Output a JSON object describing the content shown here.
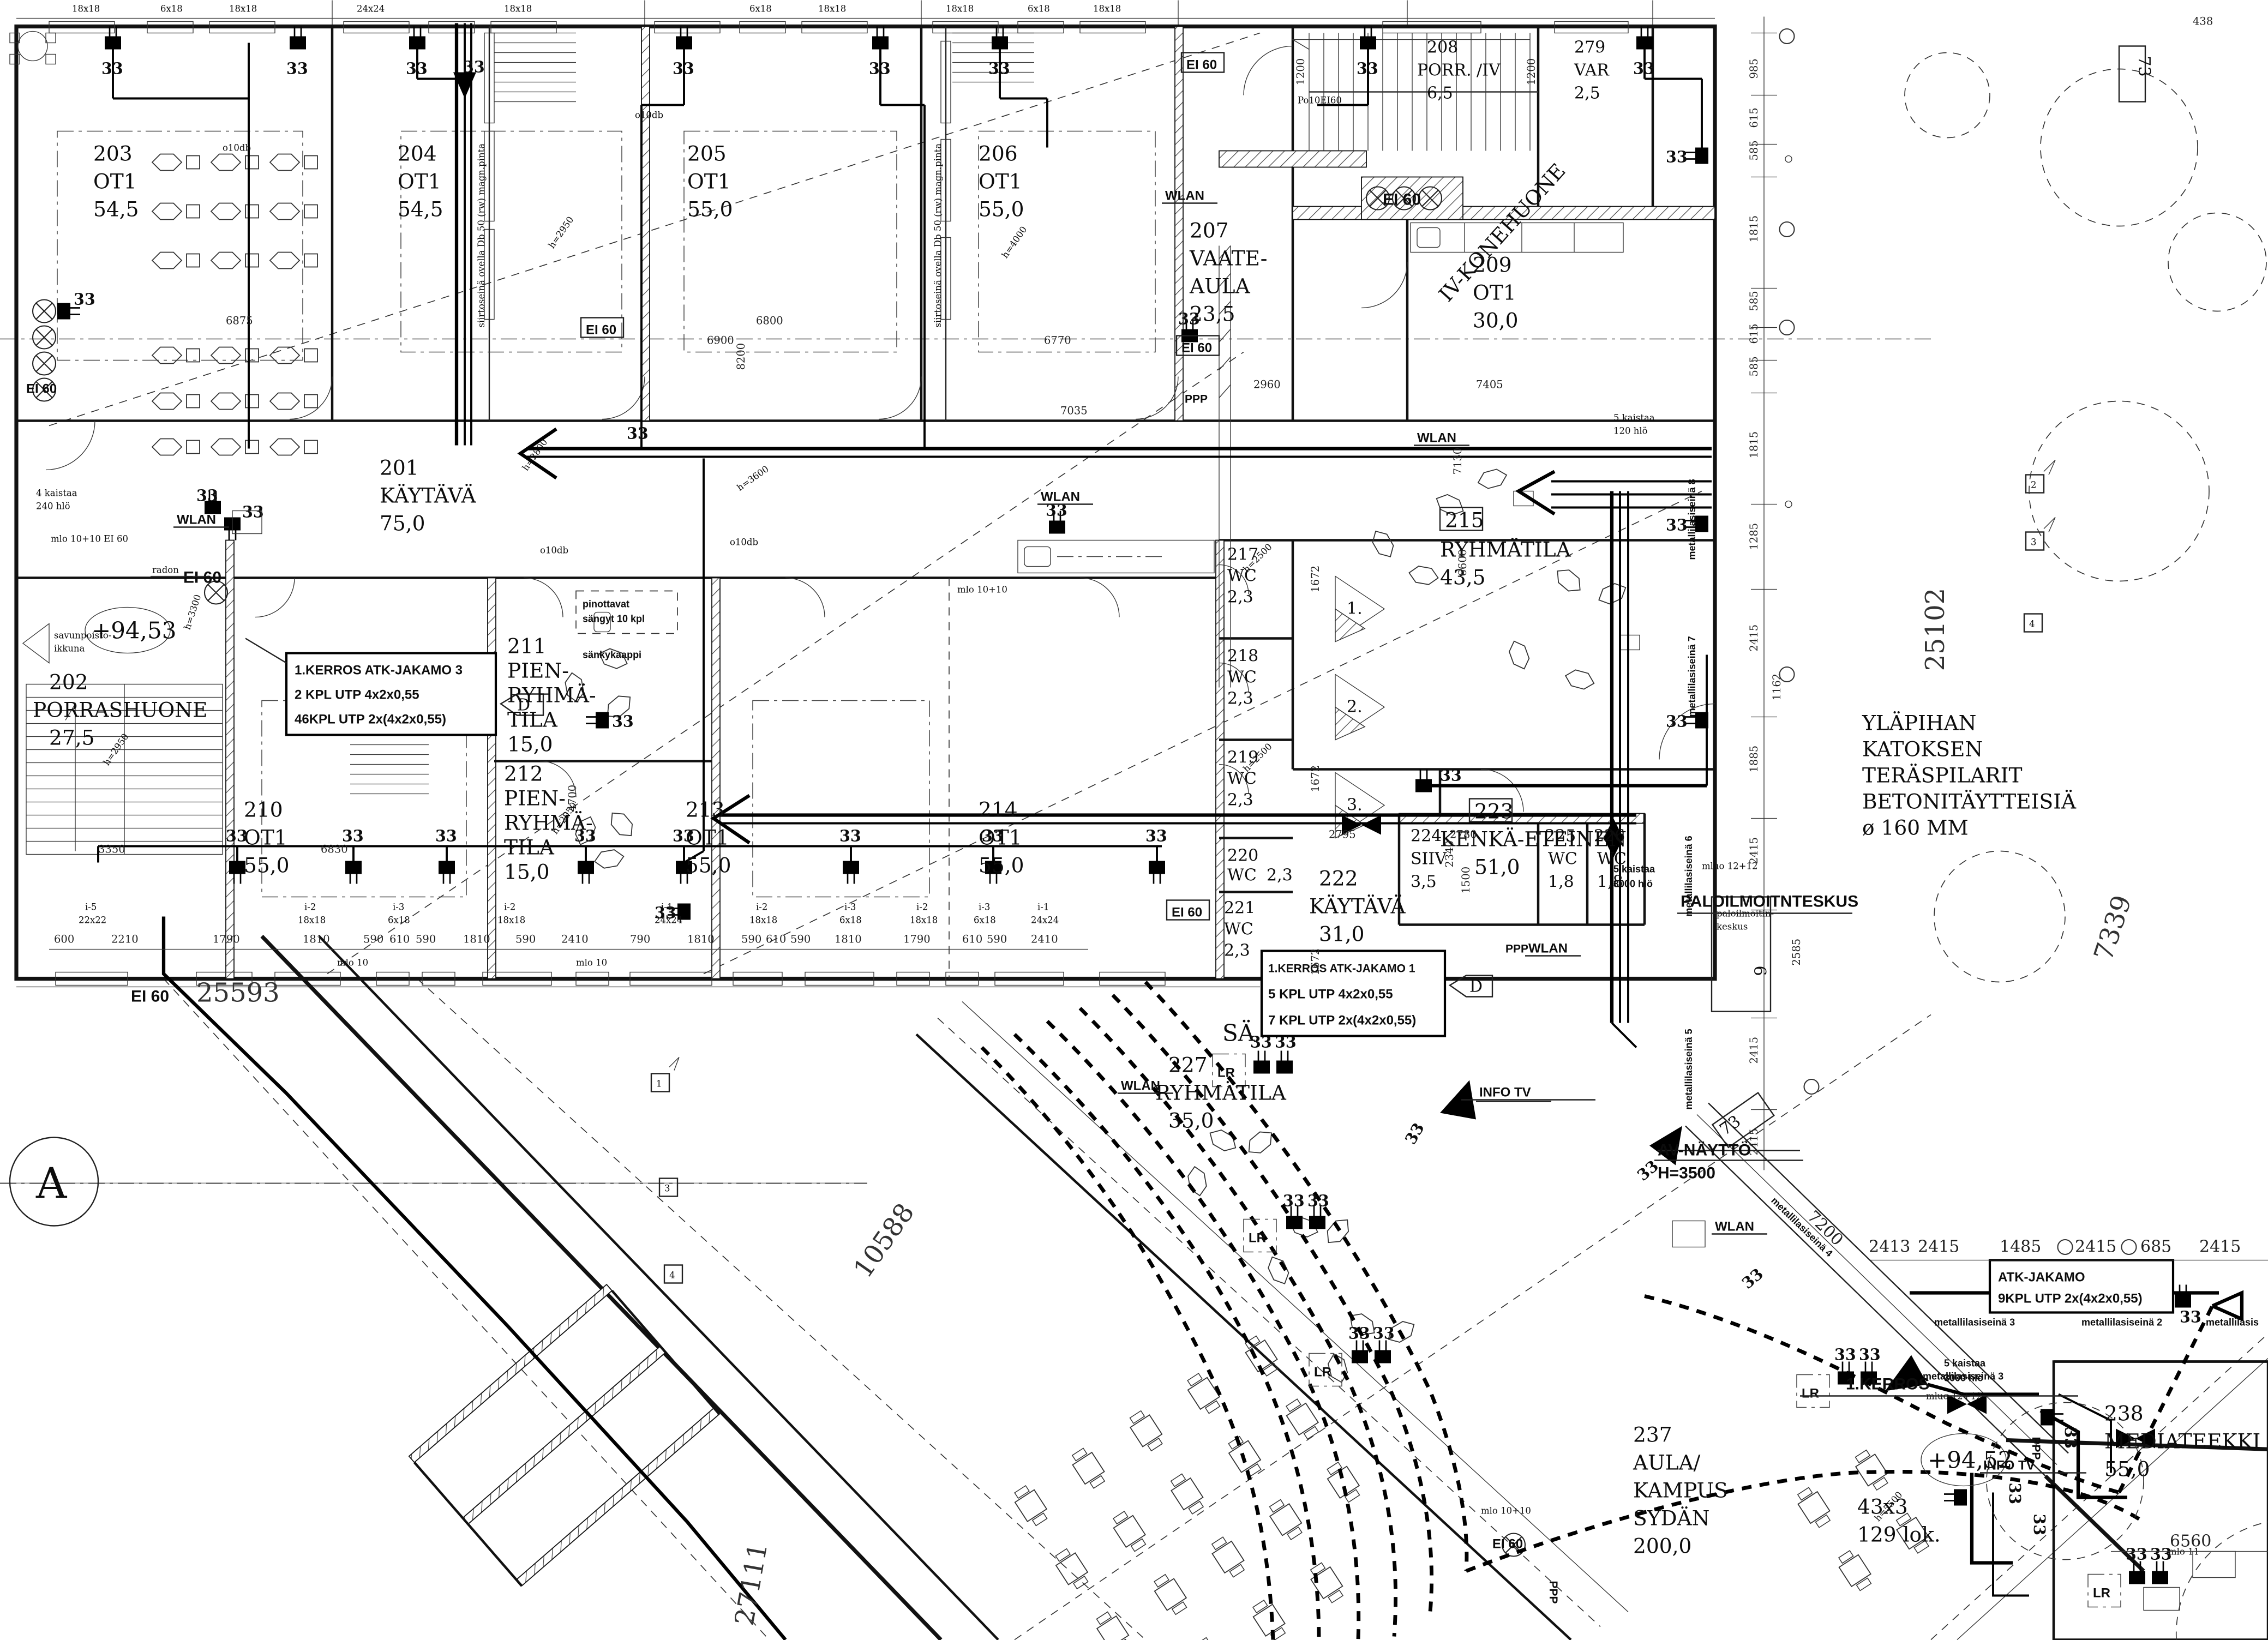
{
  "sheet": {
    "grid_letter": "A"
  },
  "labels": {
    "outlet": "33",
    "wlan": "WLAN",
    "ei60": "EI 60",
    "lr": "LR",
    "ppp": "PPP",
    "sa": "SÄ",
    "d_mark": "D",
    "info_tv": "INFO TV",
    "kerros": "1.KERROS",
    "radon": "radon",
    "o10db": "o10db",
    "mlo10": "mlo 10",
    "mlo1010": "mlo 10+10",
    "mlo1010ei60": "mlo 10+10 EI 60",
    "mlo11": "mlo 11",
    "mluo1212": "mluo 12+12",
    "po10ei60": "Po10EI60",
    "paloilmoitinkeskus": "PALOILMOITNTESKUS",
    "palok1": "paloilmoitin-",
    "palok2": "keskus",
    "palok_num": "6",
    "siirtoseina": "siirtoseinä ovella Db 50 (rw) magn.pinta",
    "pinottavat1": "pinottavat",
    "pinottavat2": "sängyt 10 kpl",
    "sankykaappi": "sänkykaappi",
    "savunpoisto1": "savunpoisto-",
    "savunpoisto2": "ikkuna",
    "kaistaa4": "4 kaistaa",
    "hlo240": "240 hlö",
    "kaistaa5": "5 kaistaa",
    "hlo120": "120 hlö",
    "hlo3000": "3000 hlö",
    "lok1": "43x3",
    "lok2": "129 lok.",
    "level_a": "+94,53",
    "level_b": "+94,52",
    "iv_konehuone": "IV-KONEHUONE",
    "num73": "73",
    "num1": "1",
    "num2": "2",
    "num3": "3",
    "num4": "4",
    "tri1": "1.",
    "tri2": "2.",
    "tri3": "3."
  },
  "annotations": {
    "atk3_l1": "1.KERROS ATK-JAKAMO 3",
    "atk3_l2": "2 KPL UTP 4x2x0,55",
    "atk3_l3": "46KPL UTP 2x(4x2x0,55)",
    "atk1_l1": "1.KERROS ATK-JAKAMO 1",
    "atk1_l2": "5 KPL UTP 4x2x0,55",
    "atk1_l3": "7 KPL UTP 2x(4x2x0,55)",
    "atk9_l1": "ATK-JAKAMO",
    "atk9_l2": "9KPL UTP 2x(4x2x0,55)",
    "av_l1": "AV-NÄYTTÖ",
    "av_l2": "H=3500",
    "ylapihan_l1": "YLÄPIHAN",
    "ylapihan_l2": "KATOKSEN",
    "ylapihan_l3": "TERÄSPILARIT",
    "ylapihan_l4": "BETONITÄYTTEISIÄ",
    "ylapihan_l5": "ø      160 MM",
    "metalli8": "metallilasiseinä 8",
    "metalli7": "metallilasiseinä 7",
    "metalli6": "metallilasiseinä 6",
    "metalli5": "metallilasiseinä 5",
    "metalli4": "metallilasiseinä 4",
    "metalli3": "metallilasiseinä 3",
    "metalli2": "metallilasiseinä 2",
    "metalli1": "metallilasis"
  },
  "rooms": {
    "r201": [
      "201",
      "KÄYTÄVÄ",
      "75,0"
    ],
    "r202": [
      "202",
      "PORRASHUONE",
      "27,5"
    ],
    "r203": [
      "203",
      "OT1",
      "54,5"
    ],
    "r204": [
      "204",
      "OT1",
      "54,5"
    ],
    "r205": [
      "205",
      "OT1",
      "55,0"
    ],
    "r206": [
      "206",
      "OT1",
      "55,0"
    ],
    "r207": [
      "207",
      "VAATE-",
      "AULA",
      "23,5"
    ],
    "r208": [
      "208",
      "PORR. /IV",
      "6,5"
    ],
    "r279": [
      "279",
      "VAR",
      "2,5"
    ],
    "r209": [
      "209",
      "OT1",
      "30,0"
    ],
    "r210": [
      "210",
      "OT1",
      "55,0"
    ],
    "r211": [
      "211",
      "PIEN-",
      "RYHMÄ-",
      "TILA",
      "15,0"
    ],
    "r212": [
      "212",
      "PIEN-",
      "RYHMÄ-",
      "TILA",
      "15,0"
    ],
    "r213": [
      "213",
      "OT1",
      "55,0"
    ],
    "r214": [
      "214",
      "OT1",
      "55,0"
    ],
    "r215": [
      "215",
      "RYHMÄTILA",
      "43,5"
    ],
    "r217": [
      "217",
      "WC",
      "2,3"
    ],
    "r218": [
      "218",
      "WC",
      "2,3"
    ],
    "r219": [
      "219",
      "WC",
      "2,3"
    ],
    "r220": [
      "220",
      "WC",
      "2,3"
    ],
    "r221": [
      "221",
      "WC",
      "2,3"
    ],
    "r222": [
      "222",
      "KÄYTÄVÄ",
      "31,0"
    ],
    "r223": [
      "223",
      "KENKÄ-ETEINEN",
      "51,0"
    ],
    "r224": [
      "224",
      "SIIV",
      "3,5"
    ],
    "r225": [
      "225",
      "WC",
      "1,8"
    ],
    "r226": [
      "226",
      "WC",
      "1,8"
    ],
    "r227": [
      "227",
      "RYHMÄTILA",
      "35,0"
    ],
    "r237": [
      "237",
      "AULA/",
      "KAMPUS",
      "SYDÄN",
      "200,0"
    ],
    "r238": [
      "238",
      "MEDIATEEKKI",
      "55,0"
    ]
  },
  "dims": {
    "bottom_row": [
      "600",
      "2210",
      "1790",
      "1810",
      "590",
      "610",
      "590",
      "1810",
      "590",
      "2410",
      "790",
      "1810",
      "590",
      "610",
      "590",
      "1810",
      "1790",
      "610",
      "590",
      "2410"
    ],
    "right_chain": [
      "985",
      "615",
      "585",
      "1815",
      "585",
      "615",
      "585",
      "1815",
      "1285",
      "2415",
      "1162",
      "1885",
      "2415",
      "2585",
      "2415",
      "2415"
    ],
    "atk_row": [
      "2413",
      "2415",
      "1485",
      "2415",
      "685",
      "2415"
    ],
    "top_row": [
      "18x18",
      "6x18",
      "18x18",
      "24x24",
      "18x18",
      "6x18",
      "18x18",
      "18x18",
      "6x18",
      "18x18"
    ],
    "win_bottom": [
      {
        "t": "i-5",
        "s": "22x22"
      },
      {
        "t": "i-2",
        "s": "18x18"
      },
      {
        "t": "i-3",
        "s": "6x18"
      },
      {
        "t": "i-2",
        "s": "18x18"
      },
      {
        "t": "i-1",
        "s": "24x24"
      },
      {
        "t": "i-2",
        "s": "18x18"
      },
      {
        "t": "i-3",
        "s": "6x18"
      },
      {
        "t": "i-2",
        "s": "18x18"
      },
      {
        "t": "i-3",
        "s": "6x18"
      },
      {
        "t": "i-1",
        "s": "24x24"
      }
    ],
    "d6875": "6875",
    "d6800": "6800",
    "d6900": "6900",
    "d8200": "8200",
    "d6770": "6770",
    "d7035": "7035",
    "d2960": "2960",
    "d7405": "7405",
    "d7130": "7130",
    "d6830": "6830",
    "d3350": "3350",
    "d1672": "1672",
    "d6600": "6600",
    "d2795": "2795",
    "d2780": "2780",
    "d1500": "1500",
    "d2340": "2340",
    "d4700": "4700",
    "d1200": "1200",
    "d25593": "25593",
    "d25102": "25102",
    "d7339": "7339",
    "d10588": "10588",
    "d27111": "27111",
    "d7200": "7200",
    "d6560": "6560",
    "d438": "438",
    "h2950": "h=2950",
    "h4000": "h=4000",
    "h3600": "h=3600",
    "h2800": "h=2800",
    "h3300": "h=3300",
    "h2500": "h=2500",
    "h5500": "h=5500"
  }
}
